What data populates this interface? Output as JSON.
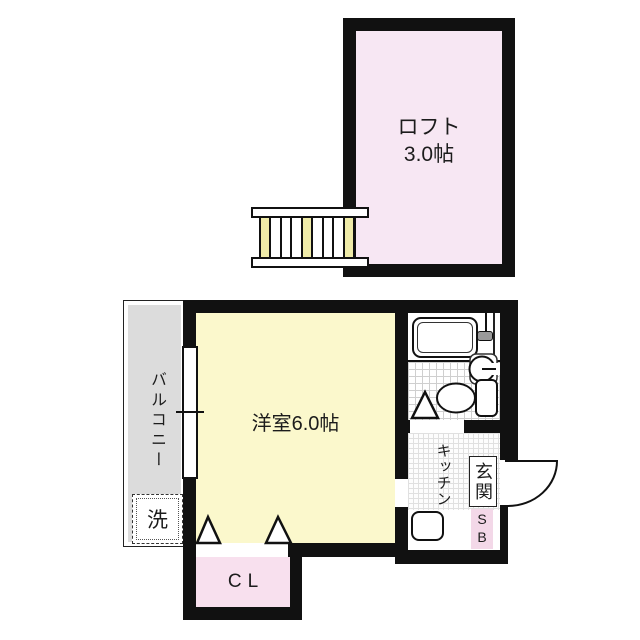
{
  "floorplan": {
    "rooms": {
      "loft": {
        "name": "ロフト",
        "size": "3.0帖"
      },
      "western_room": {
        "label": "洋室6.0帖"
      },
      "balcony": {
        "label": "バルコニー"
      },
      "washer": {
        "label": "洗"
      },
      "kitchen": {
        "label": "キッチン"
      },
      "entrance": {
        "label": "玄関"
      },
      "shoe_box": {
        "label": "SB"
      },
      "closet": {
        "label": "CL"
      }
    },
    "colors": {
      "wall": "#111111",
      "loft_fill": "#f7e7f3",
      "room_fill": "#fbf8cc",
      "closet_fill": "#f8e0ee",
      "shoebox_fill": "#f3d8e8",
      "balcony_fill": "#dcdcdc",
      "ladder_rung_fill": "#efeba8"
    }
  }
}
